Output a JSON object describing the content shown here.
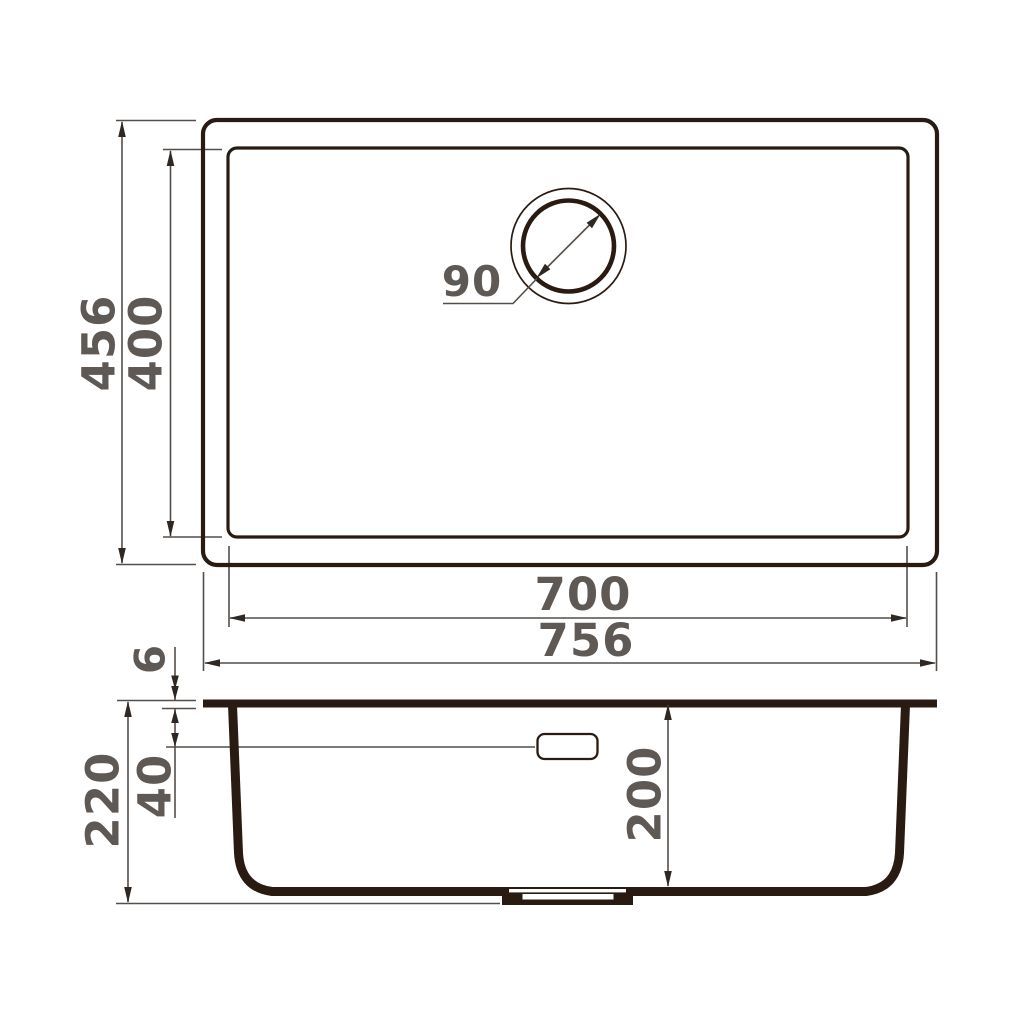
{
  "colors": {
    "background": "#ffffff",
    "object_outline": "#2a1b12",
    "dimension_lines": "#544e49",
    "dimension_text": "#5f5955"
  },
  "top_view": {
    "outer_width": "756",
    "inner_width": "700",
    "outer_depth": "456",
    "inner_depth": "400",
    "drain_diameter": "90"
  },
  "side_view": {
    "total_height": "220",
    "bowl_depth": "200",
    "rim_thickness": "6",
    "overflow_offset": "40"
  }
}
